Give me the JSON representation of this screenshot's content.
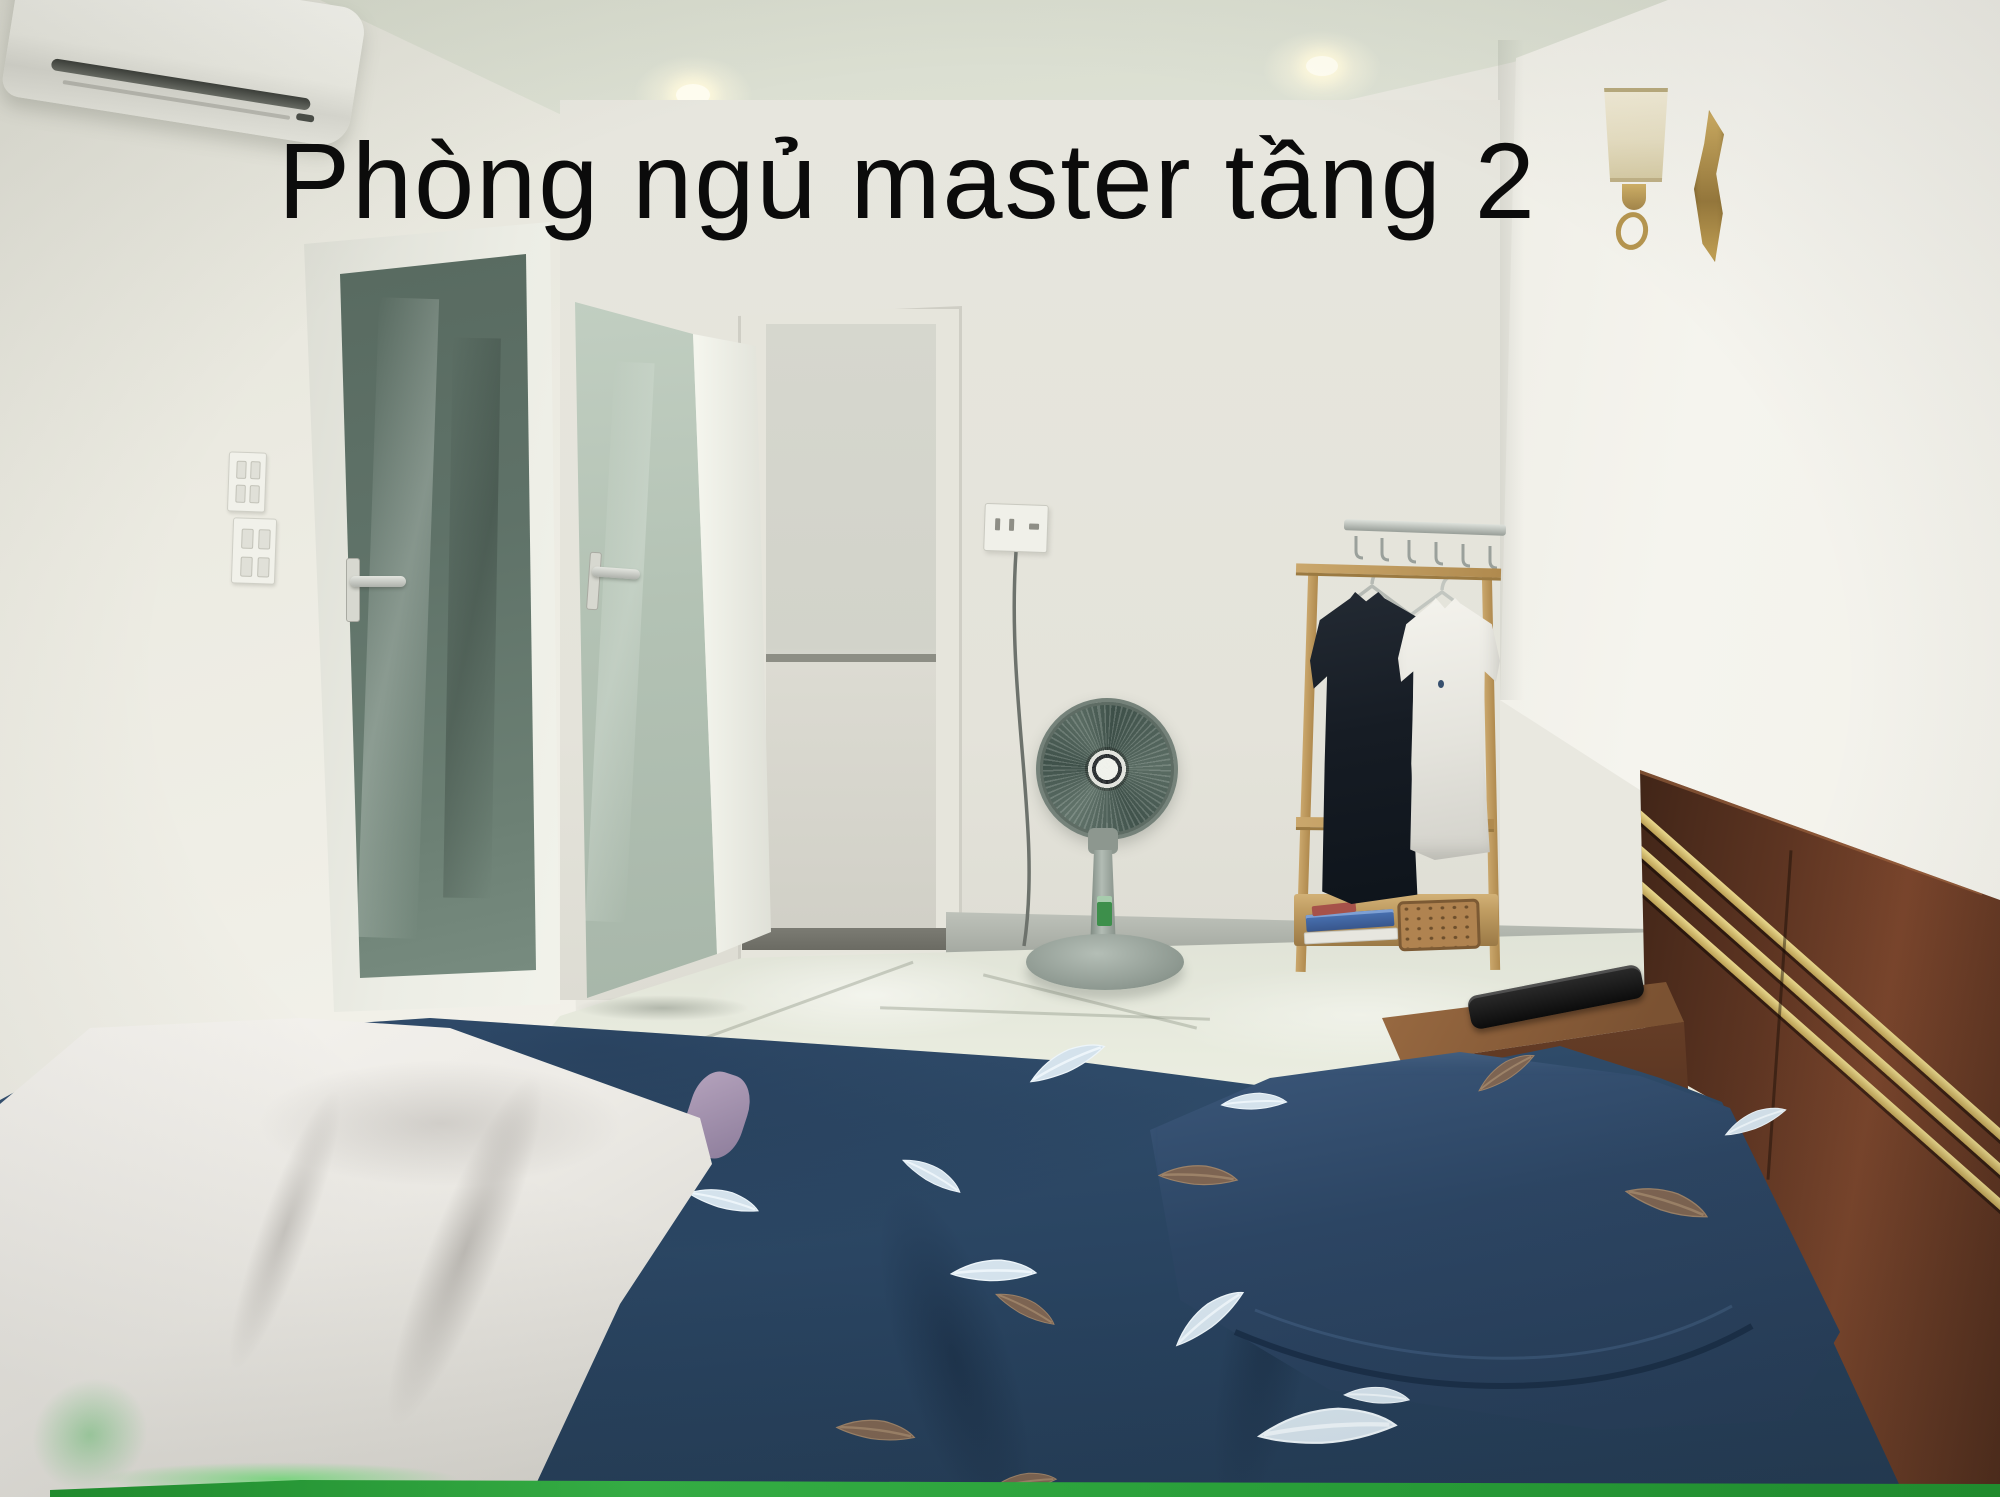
{
  "caption": {
    "text": "Phòng ngủ master tầng 2"
  },
  "scene": {
    "setting": "photo of a master bedroom on floor 2, white walls, glossy tiled floor",
    "objects": [
      "air conditioner",
      "energy label sticker",
      "recessed ceiling lights",
      "wall sconce lamp",
      "gold wall ornament",
      "light switch panels",
      "frosted glass door closed",
      "frosted glass door open",
      "open doorway to hallway",
      "power outlet",
      "power cord",
      "standing fan",
      "wall hook rail",
      "wooden clothes rack",
      "clothes hangers",
      "black polo shirt",
      "white polo shirt",
      "stacked books",
      "woven storage box",
      "dark wood headboard with brass stripes",
      "wooden nightstand",
      "black remote control",
      "navy feather-print duvet",
      "navy feather-print pillow",
      "folded floral blanket",
      "lavender blanket layer",
      "glossy tiled floor",
      "gray baseboard",
      "green strip at photo bottom"
    ],
    "colors": {
      "wall": "#eceadf",
      "ceiling": "#dde1d4",
      "right_wall": "#f5f4ee",
      "duvet_navy": "#2e4a68",
      "pillow_navy": "#2c4563",
      "blanket_white": "#efede8",
      "headboard_wood": "#5e3522",
      "brass_stripe": "#d8c88c",
      "door_glass_closed": "#5f7268",
      "door_glass_open": "#b3c2b4",
      "fan_gray": "#8d9890",
      "rack_wood": "#caa76c",
      "basket_tan": "#b08350",
      "energy_label_green": "#3cb54a",
      "bottom_strip_green": "#2aa73c",
      "caption_color": "#0b0b0b",
      "floor": "#e9ecdf",
      "baseboard_gray": "#9da29a"
    }
  }
}
